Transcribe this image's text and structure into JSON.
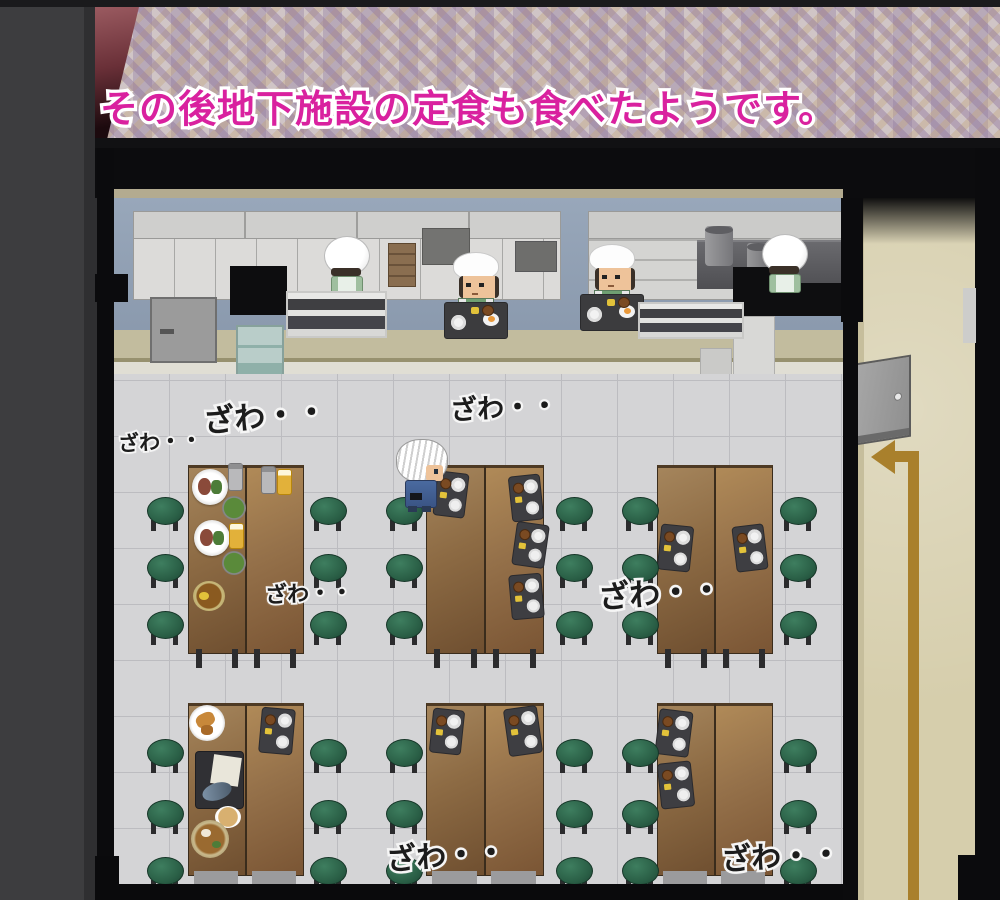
{
  "scene": {
    "description": "top-down pixel-art cafeteria of an underground facility",
    "location_label": "地下施設 食堂"
  },
  "narration": {
    "text": "その後地下施設の定食も食べたようです。",
    "text_color": "#d9219f",
    "outline_color": "#ffffff"
  },
  "ambient_texts": [
    {
      "label": "ざわ・・",
      "x": 203,
      "y": 391,
      "size": 31,
      "rot": -5
    },
    {
      "label": "ざわ・・",
      "x": 118,
      "y": 426,
      "size": 21,
      "rot": -3
    },
    {
      "label": "ざわ・・",
      "x": 450,
      "y": 386,
      "size": 27,
      "rot": -3
    },
    {
      "label": "ざわ・・",
      "x": 265,
      "y": 576,
      "size": 22,
      "rot": -2
    },
    {
      "label": "ざわ・・",
      "x": 598,
      "y": 568,
      "size": 31,
      "rot": -4
    },
    {
      "label": "ざわ・・",
      "x": 386,
      "y": 831,
      "size": 30,
      "rot": -4
    },
    {
      "label": "ざわ・・",
      "x": 721,
      "y": 832,
      "size": 30,
      "rot": -3
    }
  ],
  "characters": [
    {
      "id": "chef-back-1",
      "kind": "chef-back",
      "x": 324,
      "y": 236,
      "desc": "cook in puffy white hat and green apron facing the wall"
    },
    {
      "id": "server-1",
      "kind": "chef-front",
      "x": 452,
      "y": 252,
      "tray": true,
      "desc": "serving cook in white cap behind a tray counter"
    },
    {
      "id": "server-2",
      "kind": "chef-front",
      "x": 588,
      "y": 244,
      "tray": true,
      "desc": "serving cook in white cap behind a tray counter"
    },
    {
      "id": "chef-back-2",
      "kind": "chef-back",
      "x": 762,
      "y": 234,
      "desc": "cook in puffy white hat at the stove pots"
    },
    {
      "id": "player",
      "kind": "player",
      "x": 396,
      "y": 439,
      "desc": "white-haired visitor standing at a dining table"
    }
  ],
  "tables": [
    {
      "id": "mid-left",
      "x": 188,
      "y": 465,
      "w": 116,
      "h": 185,
      "legs": true
    },
    {
      "id": "mid-center",
      "x": 426,
      "y": 465,
      "w": 118,
      "h": 185,
      "legs": true
    },
    {
      "id": "mid-right",
      "x": 657,
      "y": 465,
      "w": 116,
      "h": 185,
      "legs": true
    },
    {
      "id": "bottom-left",
      "x": 188,
      "y": 703,
      "w": 116,
      "h": 169,
      "legs": false
    },
    {
      "id": "bottom-center",
      "x": 426,
      "y": 703,
      "w": 118,
      "h": 169,
      "legs": false
    },
    {
      "id": "bottom-right",
      "x": 657,
      "y": 703,
      "w": 116,
      "h": 169,
      "legs": false
    }
  ],
  "stools": {
    "columns": [
      147,
      310,
      386,
      556,
      622,
      780
    ],
    "mid_rows": [
      497,
      554,
      611
    ],
    "bottom_rows": [
      739,
      800,
      857
    ],
    "size": 35
  },
  "food_items": [
    {
      "kind": "meal-plate",
      "x": 192,
      "y": 469,
      "w": 36,
      "h": 36
    },
    {
      "kind": "can",
      "x": 229,
      "y": 464,
      "w": 13,
      "h": 26
    },
    {
      "kind": "can",
      "x": 262,
      "y": 467,
      "w": 13,
      "h": 26
    },
    {
      "kind": "beer",
      "x": 278,
      "y": 470,
      "w": 13,
      "h": 24
    },
    {
      "kind": "salad",
      "x": 222,
      "y": 496,
      "w": 24,
      "h": 24
    },
    {
      "kind": "meal-plate",
      "x": 194,
      "y": 520,
      "w": 36,
      "h": 36
    },
    {
      "kind": "beer",
      "x": 230,
      "y": 524,
      "w": 13,
      "h": 24
    },
    {
      "kind": "salad",
      "x": 222,
      "y": 551,
      "w": 24,
      "h": 24
    },
    {
      "kind": "curry",
      "x": 193,
      "y": 581,
      "w": 32,
      "h": 30
    },
    {
      "kind": "tray",
      "x": 436,
      "y": 473,
      "w": 30,
      "h": 43,
      "rot": 7
    },
    {
      "kind": "tray",
      "x": 511,
      "y": 476,
      "w": 30,
      "h": 44,
      "rot": -6
    },
    {
      "kind": "tray",
      "x": 515,
      "y": 524,
      "w": 31,
      "h": 42,
      "rot": 8
    },
    {
      "kind": "tray",
      "x": 511,
      "y": 575,
      "w": 31,
      "h": 43,
      "rot": -5
    },
    {
      "kind": "tray",
      "x": 660,
      "y": 526,
      "w": 31,
      "h": 44,
      "rot": 6
    },
    {
      "kind": "tray",
      "x": 735,
      "y": 526,
      "w": 30,
      "h": 44,
      "rot": -7
    },
    {
      "kind": "tempura",
      "x": 189,
      "y": 705,
      "w": 36,
      "h": 36
    },
    {
      "kind": "tray",
      "x": 261,
      "y": 709,
      "w": 32,
      "h": 44,
      "rot": 5
    },
    {
      "kind": "fish-tray",
      "x": 196,
      "y": 752,
      "w": 47,
      "h": 56
    },
    {
      "kind": "bread",
      "x": 215,
      "y": 806,
      "w": 26,
      "h": 22
    },
    {
      "kind": "noodles",
      "x": 191,
      "y": 820,
      "w": 38,
      "h": 38
    },
    {
      "kind": "tray",
      "x": 432,
      "y": 710,
      "w": 30,
      "h": 43,
      "rot": 6
    },
    {
      "kind": "tray",
      "x": 507,
      "y": 708,
      "w": 32,
      "h": 46,
      "rot": -8
    },
    {
      "kind": "tray",
      "x": 658,
      "y": 711,
      "w": 32,
      "h": 44,
      "rot": 7
    },
    {
      "kind": "tray",
      "x": 660,
      "y": 763,
      "w": 32,
      "h": 44,
      "rot": -6
    }
  ],
  "colors": {
    "narration_pink": "#d9219f",
    "floor_gray": "#d4d4d6",
    "table_brown": "#8d6b44",
    "stool_green": "#2a5f46",
    "corridor_tan": "#d6ceac",
    "arrow_gold": "#a9802c",
    "kitchen_wall_blue": "#92a2b6",
    "wall_black": "#0b0b0d"
  }
}
